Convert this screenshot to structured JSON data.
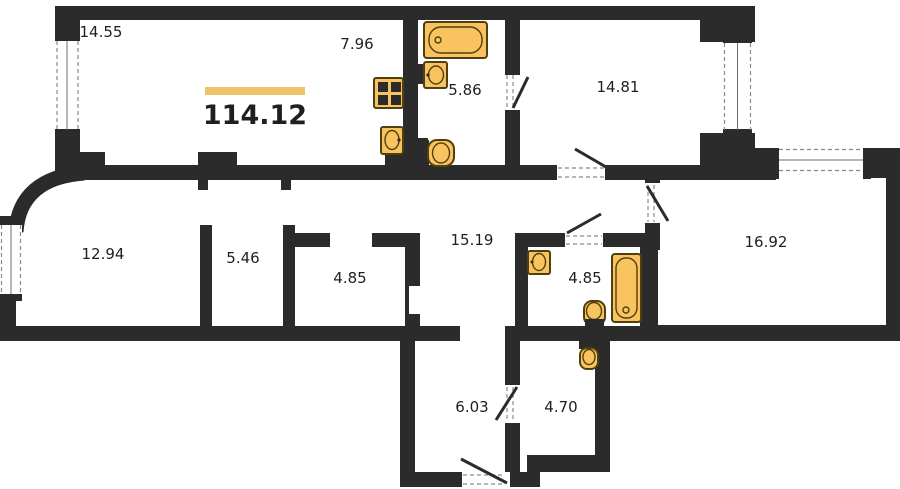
{
  "plan": {
    "total_area": "114.12",
    "rooms": [
      {
        "name": "room-top-left",
        "area": "14.55"
      },
      {
        "name": "kitchen",
        "area": "7.96"
      },
      {
        "name": "bathroom-top",
        "area": "5.86"
      },
      {
        "name": "bedroom-top-right",
        "area": "14.81"
      },
      {
        "name": "bedroom-left",
        "area": "12.94"
      },
      {
        "name": "wardrobe",
        "area": "5.46"
      },
      {
        "name": "storage",
        "area": "4.85"
      },
      {
        "name": "hallway",
        "area": "15.19"
      },
      {
        "name": "bathroom-right",
        "area": "4.85"
      },
      {
        "name": "living-room-right",
        "area": "16.92"
      },
      {
        "name": "entry-hall",
        "area": "6.03"
      },
      {
        "name": "wc-bottom",
        "area": "4.70"
      }
    ],
    "icons": [
      "bathtub-icon",
      "toilet-icon",
      "sink-icon",
      "stove-icon"
    ],
    "colors": {
      "wall": "#2B2B2B",
      "fixture_fill": "#F9C45F",
      "fixture_stroke": "#51400F",
      "accent_bar": "#EFC267",
      "background": "#FFFFFF",
      "text": "#1F1F1F"
    }
  }
}
